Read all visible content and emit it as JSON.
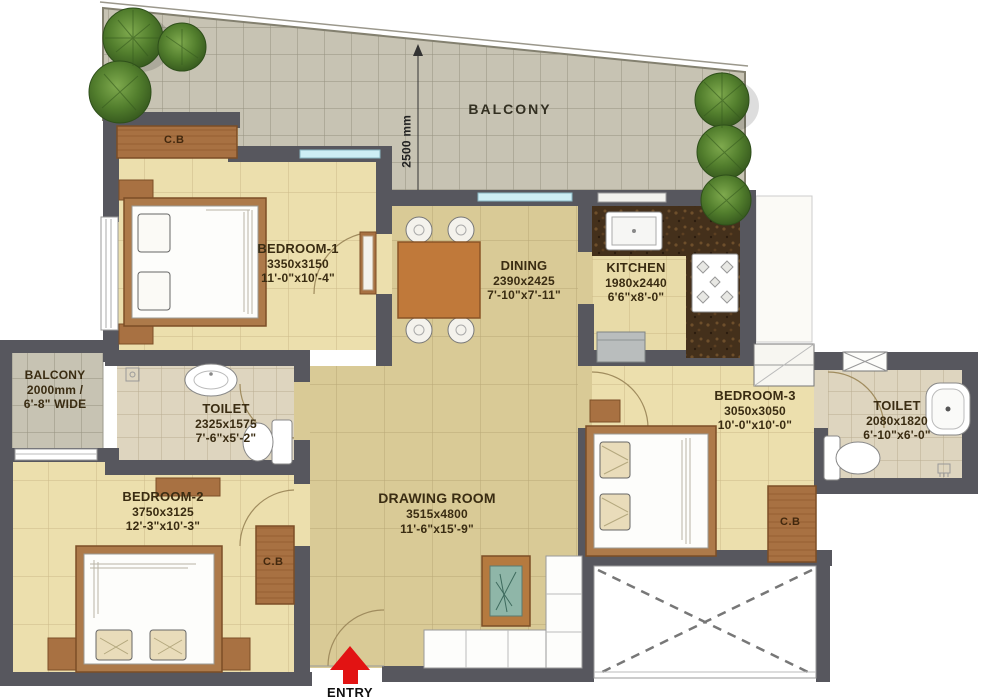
{
  "palette": {
    "wall": "#57575e",
    "floor_bedroom": "#ecdfad",
    "floor_tan": "#d9ca96",
    "balcony_tile": "#c7c3b3",
    "toilet_floor": "#ded5bf",
    "wood": "#a87142",
    "counter_dark": "#44301b",
    "entry_red": "#e21313",
    "plant_green": "#4e7a2c",
    "window_blue": "#cdeef5",
    "label_text": "#3a2c12"
  },
  "labels": {
    "cupboard": "C.B",
    "entry": "ENTRY"
  },
  "rooms": {
    "balcony_top": {
      "name": "BALCONY",
      "depth": "2500 mm"
    },
    "bedroom1": {
      "name": "BEDROOM-1",
      "size_mm": "3350x3150",
      "size_ft": "11'-0\"x10'-4\""
    },
    "dining": {
      "name": "DINING",
      "size_mm": "2390x2425",
      "size_ft": "7'-10\"x7'-11\""
    },
    "kitchen": {
      "name": "KITCHEN",
      "size_mm": "1980x2440",
      "size_ft": "6'6\"x8'-0\""
    },
    "balcony_left": {
      "name": "BALCONY",
      "line2": "2000mm /",
      "line3": "6'-8\" WIDE"
    },
    "toilet1": {
      "name": "TOILET",
      "size_mm": "2325x1575",
      "size_ft": "7'-6\"x5'-2\""
    },
    "bedroom2": {
      "name": "BEDROOM-2",
      "size_mm": "3750x3125",
      "size_ft": "12'-3\"x10'-3\""
    },
    "drawing": {
      "name": "DRAWING ROOM",
      "size_mm": "3515x4800",
      "size_ft": "11'-6\"x15'-9\""
    },
    "bedroom3": {
      "name": "BEDROOM-3",
      "size_mm": "3050x3050",
      "size_ft": "10'-0\"x10'-0\""
    },
    "toilet2": {
      "name": "TOILET",
      "size_mm": "2080x1820",
      "size_ft": "6'-10\"x6'-0\""
    }
  }
}
